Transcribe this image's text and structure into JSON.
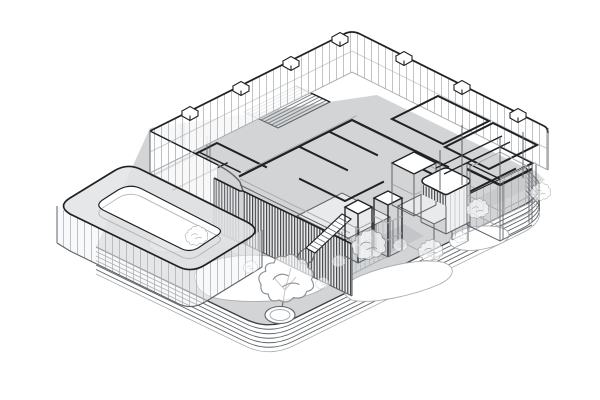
{
  "meta": {
    "kind": "architectural-axonometric-drawing",
    "description": "Black-and-white isometric cutaway drawing of a building complex: glazed upper-floor band with rooftop units, cut interior partition walls, a louvered core with an internal stair, framed service cores and a pergola, all standing on a stepped rounded-corner plinth with a grey courtyard, white garden paths, sketched trees, shrubs and a small round pond.",
    "text_content_present": false
  },
  "palette": {
    "ink": "#1f2123",
    "line": "#5f6367",
    "faint": "#a8acb0",
    "ground": "#d2d4d6",
    "shadow": "#c0c2c5",
    "wallfill": "#f0f1f2",
    "white": "#ffffff",
    "louver": "#3a3d40",
    "paper": "#ffffff"
  },
  "elements": {
    "labels": [
      "stepped-plinth",
      "courtyard-ground",
      "garden-paths",
      "pavilion-ring",
      "glass-band",
      "rooftop-units",
      "interior-partitions",
      "hatched-deck",
      "louver-facade",
      "stair",
      "shaft-towers",
      "service-cores",
      "pergola-frame",
      "glazed-fence",
      "column-row",
      "trees",
      "shrubs",
      "pond"
    ]
  }
}
